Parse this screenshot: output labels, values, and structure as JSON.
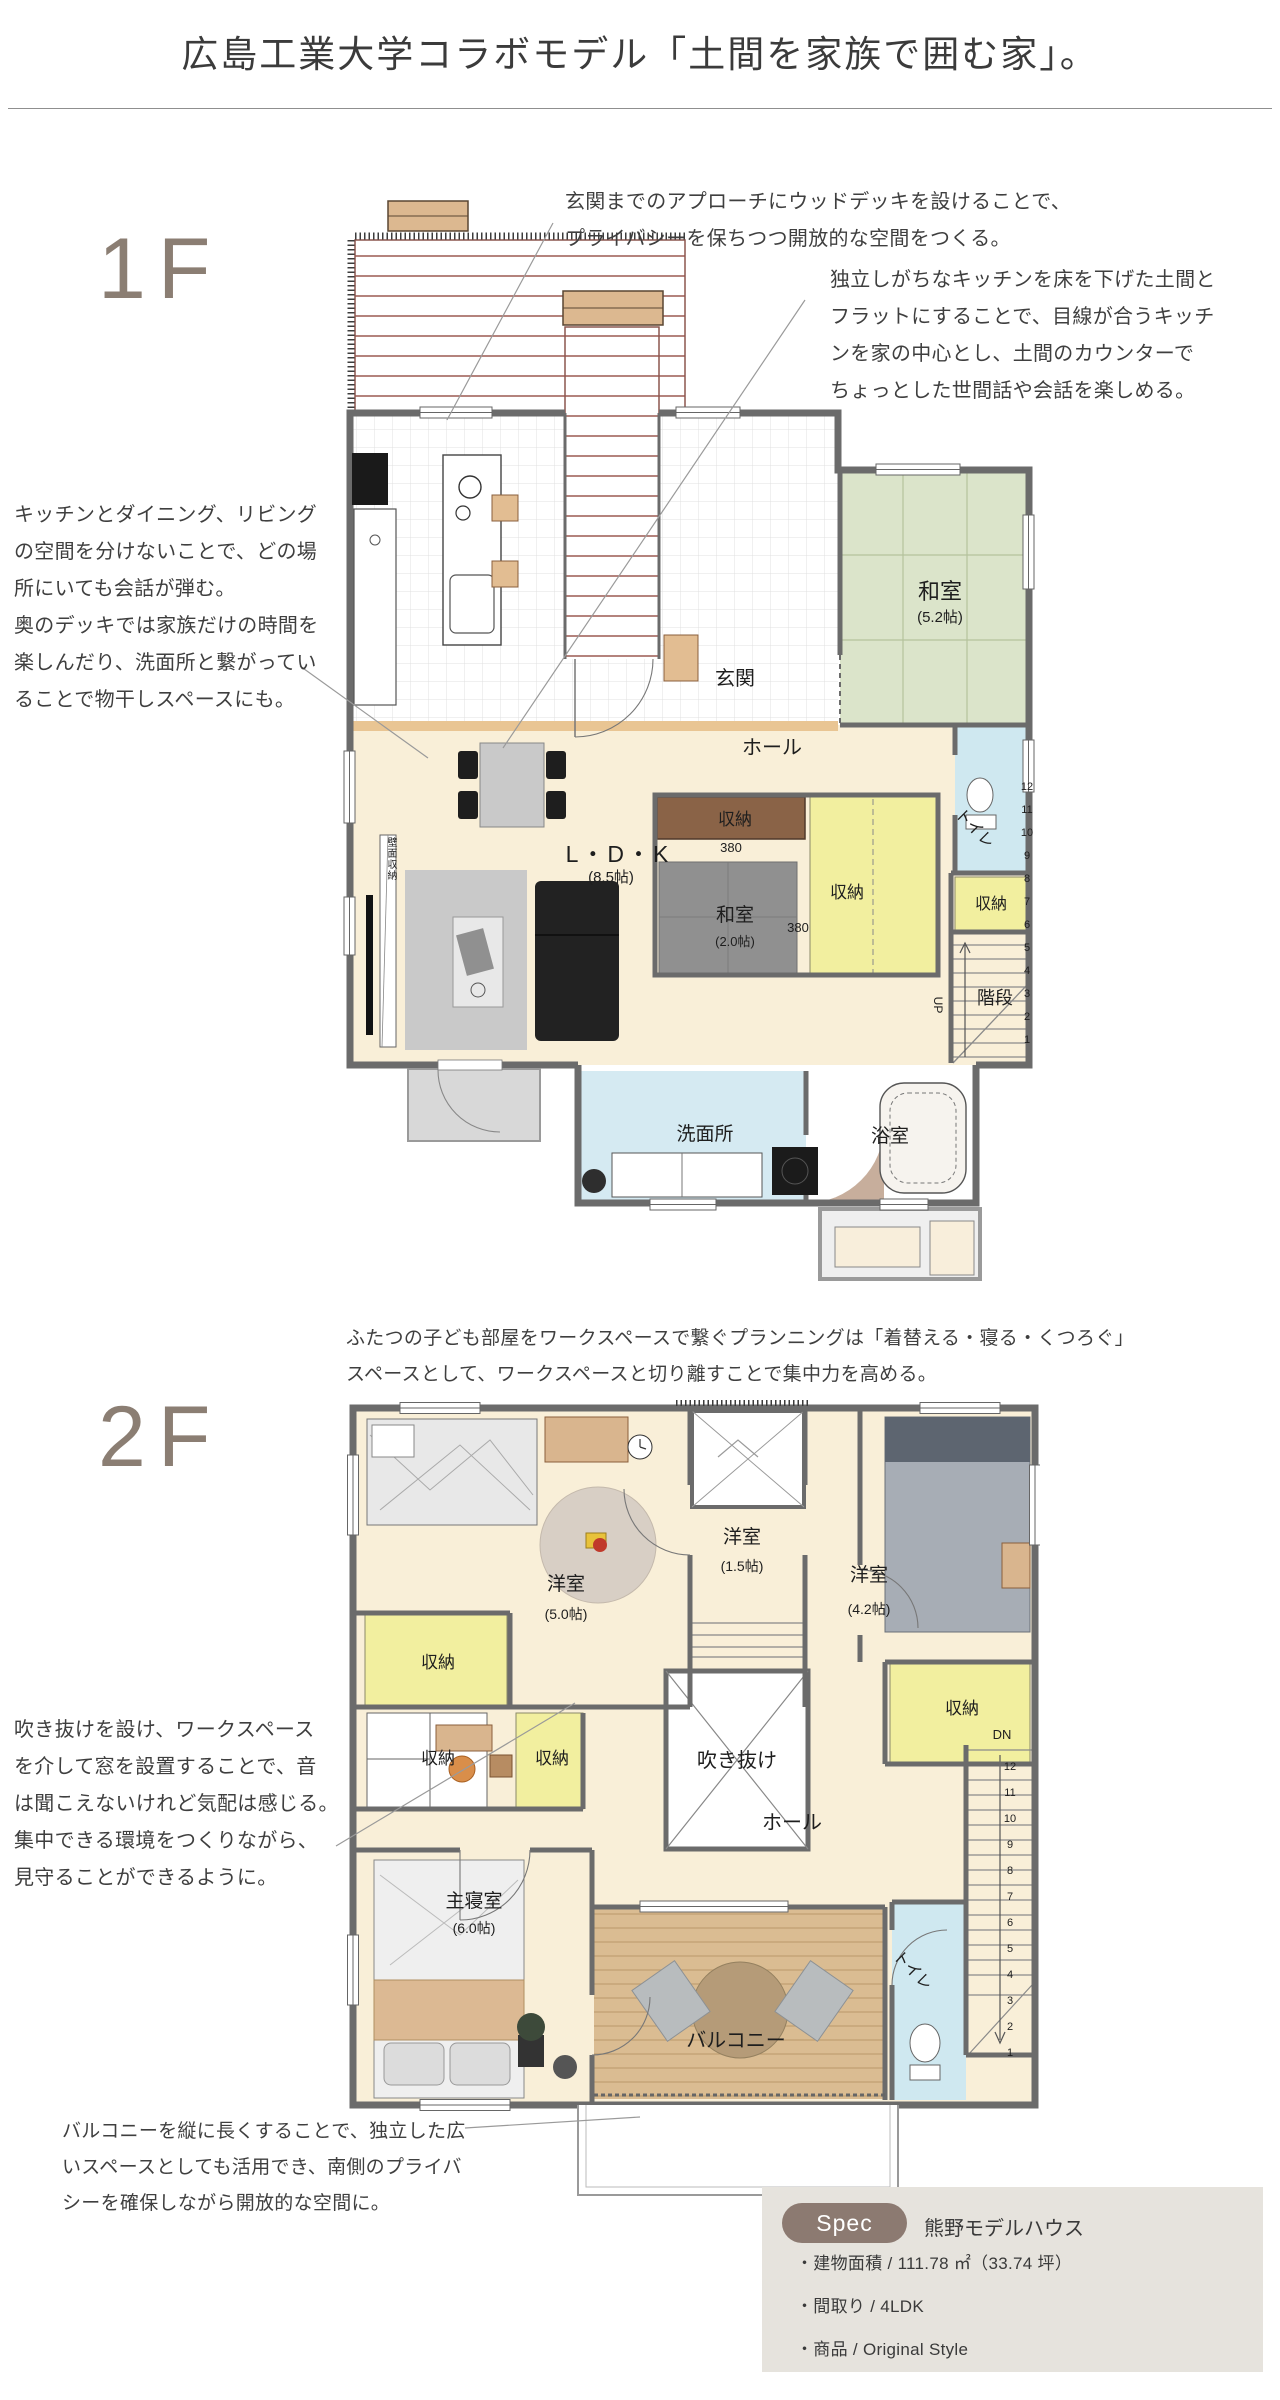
{
  "title": "広島工業大学コラボモデル「土間を家族で囲む家」。",
  "floor1": {
    "label": "1F",
    "ann_approach": "玄関までのアプローチにウッドデッキを設けることで、\nプライバシーを保ちつつ開放的な空間をつくる。",
    "ann_doma": "独立しがちなキッチンを床を下げた土間と\nフラットにすることで、目線が合うキッチ\nンを家の中心とし、土間のカウンターで\nちょっとした世間話や会話を楽しめる。",
    "ann_ldk": "キッチンとダイニング、リビング\nの空間を分けないことで、どの場\n所にいても会話が弾む。\n奥のデッキでは家族だけの時間を\n楽しんだり、洗面所と繋がってい\nることで物干しスペースにも。",
    "rooms": {
      "washitsu52": "和室",
      "washitsu52_size": "(5.2帖)",
      "genkan": "玄関",
      "hall": "ホール",
      "ldk": "L・D・K",
      "ldk_size": "(8.5帖)",
      "closet1": "収納",
      "dim380a": "380",
      "washitsu20": "和室",
      "washitsu20_size": "(2.0帖)",
      "dim380b": "380",
      "closet2": "収納",
      "toilet": "トイレ",
      "closet3": "収納",
      "stairs": "階段",
      "up": "UP",
      "stair_nums": "12\n11\n10\n9\n8\n7\n6\n5\n4\n3\n2\n1",
      "wall_storage": "壁面収納",
      "washroom": "洗面所",
      "bath": "浴室"
    }
  },
  "floor2": {
    "label": "2F",
    "ann_kids": "ふたつの子ども部屋をワークスペースで繋ぐプランニングは「着替える・寝る・くつろぐ」\nスペースとして、ワークスペースと切り離すことで集中力を高める。",
    "ann_void": "吹き抜けを設け、ワークスペース\nを介して窓を設置することで、音\nは聞こえないけれど気配は感じる。\n集中できる環境をつくりながら、\n見守ることができるように。",
    "ann_balcony": "バルコニーを縦に長くすることで、独立した広\nいスペースとしても活用でき、南側のプライバ\nシーを確保しながら開放的な空間に。",
    "rooms": {
      "kids1": "洋室",
      "kids1_size": "(5.0帖)",
      "work": "洋室",
      "work_size": "(1.5帖)",
      "kids2": "洋室",
      "kids2_size": "(4.2帖)",
      "closet_l": "収納",
      "closet_ls": "収納",
      "closet_c": "収納",
      "closet_r": "収納",
      "void": "吹き抜け",
      "hall": "ホール",
      "master": "主寝室",
      "master_size": "(6.0帖)",
      "balcony": "バルコニー",
      "toilet": "トイレ",
      "dn": "DN",
      "stair_nums": "12\n11\n10\n9\n8\n7\n6\n5\n4\n3\n2\n1"
    }
  },
  "spec": {
    "badge": "Spec",
    "name": "熊野モデルハウス",
    "items": [
      "・建物面積 / 111.78 ㎡（33.74 坪）",
      "・間取り / 4LDK",
      "・商品 / Original Style"
    ]
  },
  "colors": {
    "accent_taupe": "#8b7e73",
    "tatami_green": "#dbe4ca",
    "floor_cream": "#f9efd8",
    "closet_yellow": "#f2ef9f",
    "closet_brown": "#8a6347",
    "water_blue": "#d5eaf2",
    "deck_maroon": "#9b5a52",
    "balcony_wood": "#dabc92",
    "wall_gray": "#6b6b6b"
  }
}
